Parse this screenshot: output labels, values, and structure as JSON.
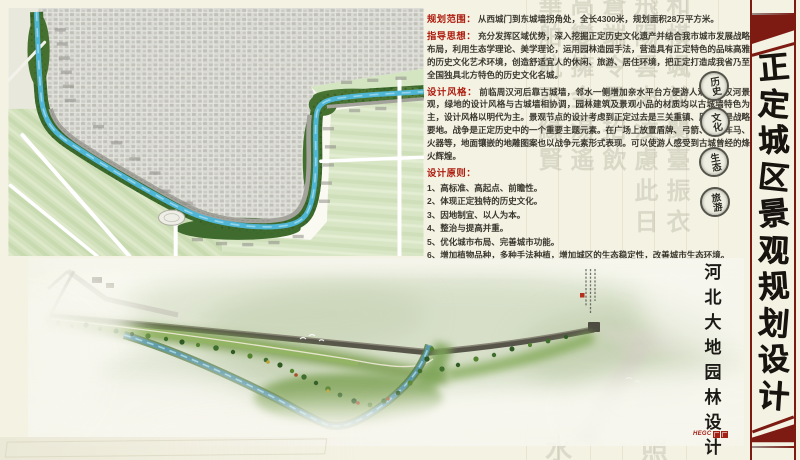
{
  "poster": {
    "colors": {
      "cream": "#f3f2e3",
      "banner_red": "#7d1b12",
      "heading_red": "#ae1a0c",
      "map_water": "#4fb6d6",
      "map_vegetation": "#3c6a2c"
    }
  },
  "title": {
    "text": "正定城区景观规划设计"
  },
  "credit": {
    "text": "河北大地园林设计院",
    "logo_text": "HEGC"
  },
  "sections": {
    "scope_label": "规划范围：",
    "scope_text": "从西城门到东城墙拐角处，全长4300米，规划面积28万平方米。",
    "guiding_label": "指导思想：",
    "guiding_text": "充分发挥区域优势，深入挖掘正定历史文化遗产并结合我市城市发展战略布局，利用生态学理论、美学理论，运用园林造园手法，营造具有正定特色的品味高雅的历史文化艺术环境，创造舒适宜人的休闲、旅游、居住环境，把正定打造成我省乃至全国独具北方特色的历史文化名城。",
    "style_label": "设计风格：",
    "style_text": "前临周汉河后靠古城墙，邻水一侧增加亲水平台方便游人观赏周汉河景观，绿地的设计风格与古城墙相协调，园林建筑及景观小品的材质均以古城墙特色为主，设计风格以明代为主。景观节点的设计考虑到正定过去是三关重镇、历史上是战略要地。战争是正定历史中的一个重要主题元素。在广场上放置盾牌、弓箭、废旧车马、火器等，地面镶嵌的地雕图案也以战争元素形式表现。可以使游人感受到古城曾经的烽火辉煌。",
    "principles_label": "设计原则：",
    "principles": [
      "1、高标准、高起点、前瞻性。",
      "2、体现正定独特的历史文化。",
      "3、因地制宜、以人为本。",
      "4、整治与提高并重。",
      "5、优化城市布局、完善城市功能。",
      "6、增加植物品种，多种手法种植，增加城区的生态稳定性，改善城市生态环境。"
    ]
  },
  "seals": [
    "历史",
    "文化",
    "生态",
    "旅游"
  ],
  "watermark": {
    "columns": [
      "華舶航不緣賢",
      "高變擁金湯遙",
      "蒼端令君招飲",
      "飛陽雲來淩慮此日",
      "和橫颯並蘭臺振衣"
    ],
    "bottom_chars": [
      "水",
      "照"
    ]
  }
}
